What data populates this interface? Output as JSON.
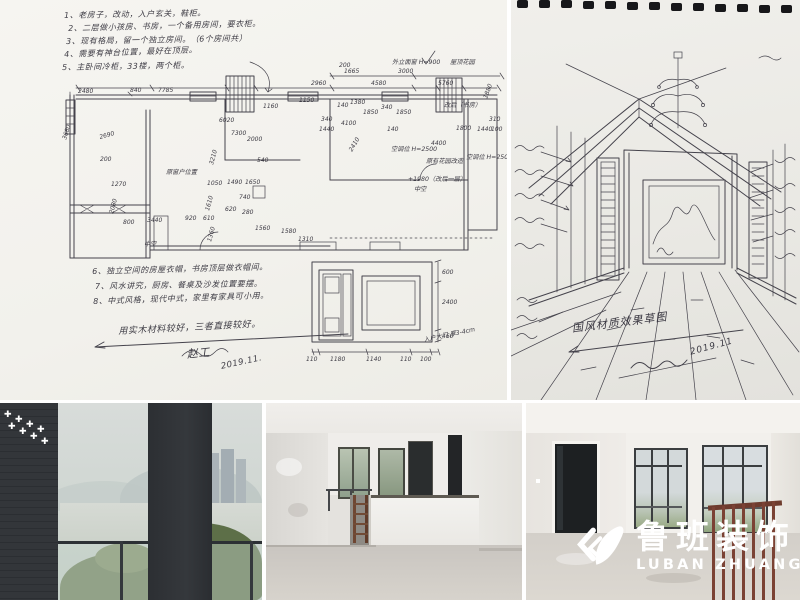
{
  "colors": {
    "paper_left": "#f4f3ef",
    "paper_right": "#eae9e4",
    "ink": "#45434c",
    "logo_white": "#ffffff",
    "brick_wall": "#33363a",
    "rust_rail": "#7b4234",
    "concrete_floor": "#d0ccc6"
  },
  "logo": {
    "zh": "鲁班装饰",
    "en": "LUBAN ZHUANGSHI"
  },
  "left_sketch": {
    "notes_top": [
      "1、老房子，改动，入户玄关，鞋柜。",
      "2、二层做小孩房、书房，一个备用房间，要衣柜。",
      "3、现有格局，留一个独立房间。（6个房间共）",
      "4、需要有神台位置，最好在顶层。",
      "5、主卧间冷柜，33楼，两个柜。"
    ],
    "notes_bottom": [
      "6、独立空间的房屋衣帽，书房顶层做衣帽间。",
      "7、风水讲究，厨房、餐桌及沙发位置要摆。",
      "8、中式风格，现代中式，家里有家具可小用。"
    ],
    "closing_note": "用实木材料较好，三者直接较好。",
    "signature": "赵工",
    "date": "2019.11.",
    "labels": {
      "roof_garden": "屋顶花园",
      "facade": "外立面窗 H=900",
      "old_window": "原窗户位置",
      "study": "改后（书房）",
      "ac1": "空调位 H=2500",
      "ac2": "空调位 H=2500",
      "garden": "原有花园改造",
      "level": "+1980（改后一层）",
      "void_right": "中空",
      "void_left": "中空",
      "entry_door": "入户大门 厚3-4cm"
    },
    "dims": [
      "2480",
      "840",
      "7785",
      "1665",
      "3000",
      "2960",
      "4580",
      "5760",
      "200",
      "1880",
      "140",
      "1380",
      "1850",
      "340",
      "1850",
      "340",
      "4100",
      "1440",
      "140",
      "1800",
      "1440",
      "100",
      "3680",
      "2690",
      "200",
      "1270",
      "2080",
      "800",
      "3440",
      "920",
      "610",
      "3210",
      "1050",
      "1490",
      "1650",
      "740",
      "1610",
      "620",
      "280",
      "1360",
      "7300",
      "2000",
      "6020",
      "1160",
      "540",
      "4400",
      "2410",
      "310",
      "1560",
      "1580",
      "1310",
      "1150"
    ],
    "detail_dims": [
      "600",
      "2400",
      "460"
    ],
    "detail_widths": [
      "110",
      "1180",
      "1140",
      "110",
      "100"
    ]
  },
  "right_sketch": {
    "title": "国风材质效果草图",
    "date": "2019.11"
  },
  "photos": {
    "balcony": {
      "sparkle_char": "✚"
    }
  }
}
